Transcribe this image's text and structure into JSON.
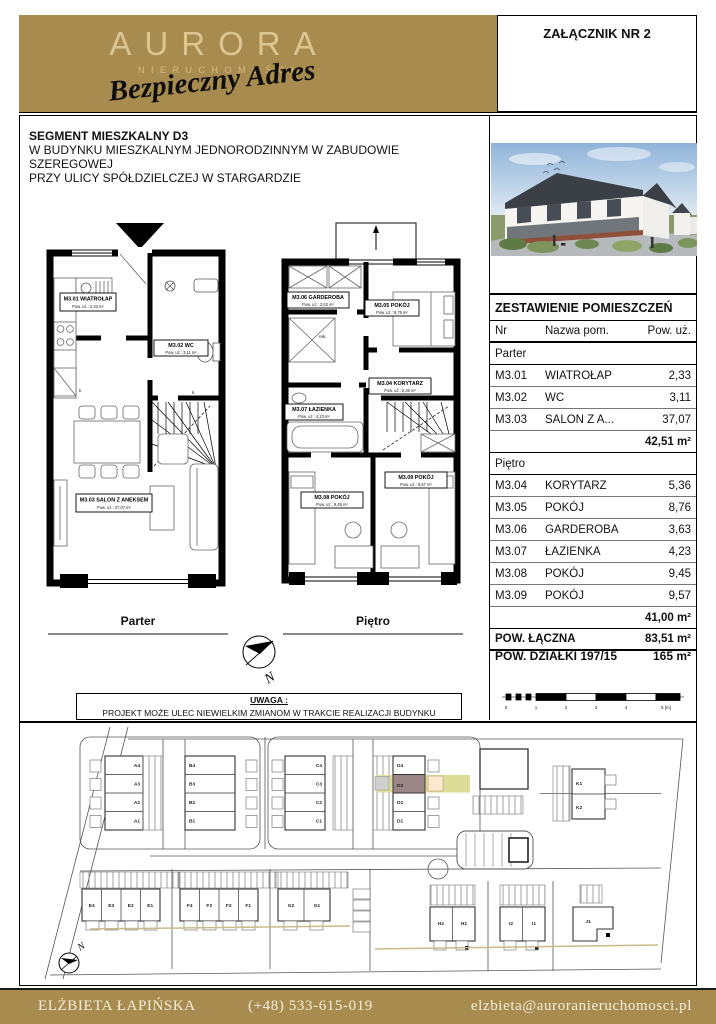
{
  "header": {
    "brand": "AURORA",
    "brand_sub": "NIERUCHOMOŚCI",
    "tagline": "Bezpieczny Adres",
    "attachment": "ZAŁĄCZNIK NR 2"
  },
  "title_block": {
    "line1": "SEGMENT MIESZKALNY D3",
    "line2": "W BUDYNKU MIESZKALNYM JEDNORODZINNYM W ZABUDOWIE SZEREGOWEJ",
    "line3": "PRZY ULICY SPÓŁDZIELCZEJ W STARGARDZIE"
  },
  "floor_plans": {
    "parter": {
      "caption": "Parter",
      "rooms": [
        {
          "title": "M3.01 WIATROŁAP",
          "area": "Pow. uż.: 2,33 m²"
        },
        {
          "title": "M3.02 WC",
          "area": "Pow. uż.: 3,11 m²"
        },
        {
          "title": "M3.03 SALON Z ANEKSEM",
          "area": "Pow. uż.: 37,07 m²"
        }
      ],
      "annotations": [
        "k",
        "k"
      ]
    },
    "pietro": {
      "caption": "Piętro",
      "rooms": [
        {
          "title": "M3.04 KORYTARZ",
          "area": "Pow. uż.: 5,36 m²"
        },
        {
          "title": "M3.05 POKÓJ",
          "area": "Pow. uż.: 8,76 m²"
        },
        {
          "title": "M3.06 GARDEROBA",
          "area": "Pow. uż.: 3,63 m²"
        },
        {
          "title": "M3.07 ŁAZIENKA",
          "area": "Pow. uż.: 4,23 m²"
        },
        {
          "title": "M3.08 POKÓJ",
          "area": "Pow. uż.: 9,45 m²"
        },
        {
          "title": "M3.09 POKÓJ",
          "area": "Pow. uż.: 9,57 m²"
        }
      ],
      "annotations": [
        "rek.",
        "k"
      ]
    }
  },
  "compass": {
    "label": "N"
  },
  "note": {
    "title": "UWAGA :",
    "text": "PROJEKT MOŻE ULEC NIEWIELKIM ZMIANOM W TRAKCIE REALIZACJI BUDYNKU"
  },
  "summary_table": {
    "title": "ZESTAWIENIE POMIESZCZEŃ",
    "columns": [
      "Nr",
      "Nazwa pom.",
      "Pow. uż."
    ],
    "sections": [
      {
        "name": "Parter",
        "rows": [
          [
            "M3.01",
            "WIATROŁAP",
            "2,33"
          ],
          [
            "M3.02",
            "WC",
            "3,11"
          ],
          [
            "M3.03",
            "SALON Z A...",
            "37,07"
          ]
        ],
        "subtotal": "42,51 m²"
      },
      {
        "name": "Piętro",
        "rows": [
          [
            "M3.04",
            "KORYTARZ",
            "5,36"
          ],
          [
            "M3.05",
            "POKÓJ",
            "8,76"
          ],
          [
            "M3.06",
            "GARDEROBA",
            "3,63"
          ],
          [
            "M3.07",
            "ŁAZIENKA",
            "4,23"
          ],
          [
            "M3.08",
            "POKÓJ",
            "9,45"
          ],
          [
            "M3.09",
            "POKÓJ",
            "9,57"
          ]
        ],
        "subtotal": "41,00 m²"
      }
    ],
    "total_label": "POW. ŁĄCZNA",
    "total_value": "83,51 m²",
    "plot_label": "POW. DZIAŁKI 197/15",
    "plot_value": "165 m²"
  },
  "scale_bar": {
    "ticks": [
      "0",
      "1",
      "2",
      "3",
      "4",
      "5 [m]"
    ]
  },
  "site_plan": {
    "highlighted": "D3",
    "compass_label": "N",
    "blocks": [
      {
        "id": "A",
        "units": [
          "A4",
          "A3",
          "A2",
          "A1"
        ]
      },
      {
        "id": "B",
        "units": [
          "B4",
          "B3",
          "B2",
          "B1"
        ]
      },
      {
        "id": "C",
        "units": [
          "C4",
          "C3",
          "C2",
          "C1"
        ]
      },
      {
        "id": "D",
        "units": [
          "D4",
          "D3",
          "D2",
          "D1"
        ]
      },
      {
        "id": "E",
        "units": [
          "E4",
          "E3",
          "E2",
          "E1"
        ]
      },
      {
        "id": "F",
        "units": [
          "F4",
          "F3",
          "F2",
          "F1"
        ]
      },
      {
        "id": "G",
        "units": [
          "G2",
          "G1"
        ]
      },
      {
        "id": "H",
        "units": [
          "H2",
          "H1"
        ]
      },
      {
        "id": "I",
        "units": [
          "I2",
          "I1"
        ]
      },
      {
        "id": "J",
        "units": [
          "J1"
        ]
      },
      {
        "id": "K",
        "units": [
          "K1",
          "K2"
        ]
      }
    ]
  },
  "footer": {
    "name": "ELŻBIETA ŁAPIŃSKA",
    "phone": "(+48) 533-615-019",
    "email": "elzbieta@auroranieruchomosci.pl"
  },
  "colors": {
    "gold": "#a88b4e",
    "logo_text": "#dbc591",
    "highlight_unit": "#9b8787",
    "highlight_strip": "#dcdd96",
    "highlight_square": "#fbe9cf"
  }
}
